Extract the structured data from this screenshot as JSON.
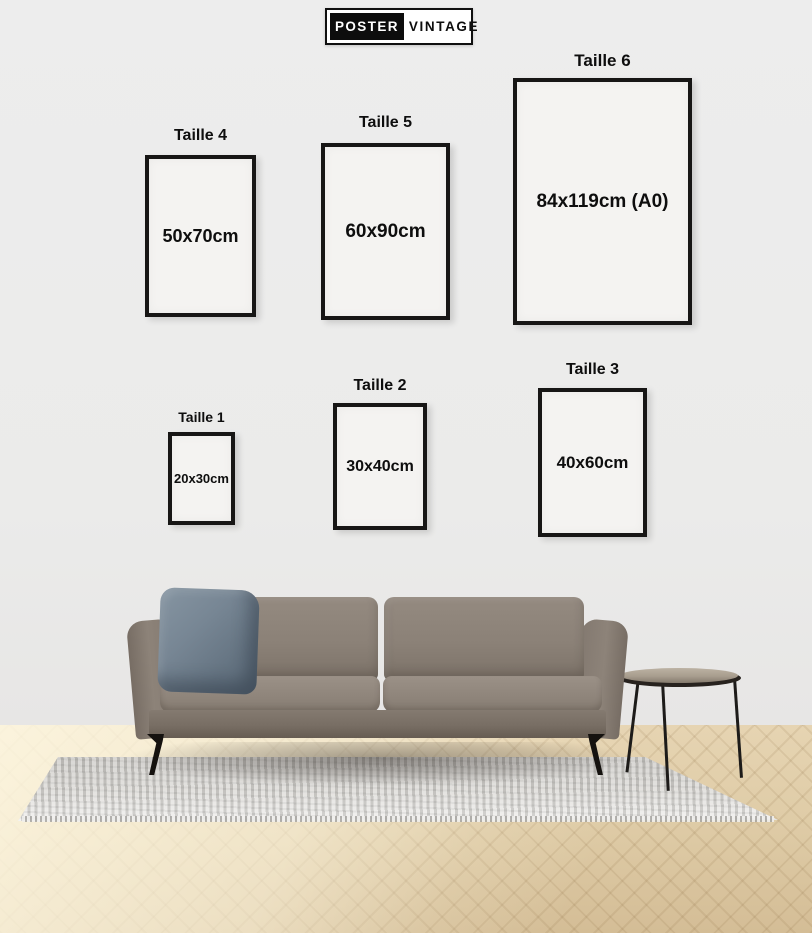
{
  "brand": {
    "name_left": "POSTER",
    "name_right": "VINTAGE"
  },
  "size_guide": {
    "frames": [
      {
        "label": "Taille 1",
        "size": "20x30cm"
      },
      {
        "label": "Taille 2",
        "size": "30x40cm"
      },
      {
        "label": "Taille 3",
        "size": "40x60cm"
      },
      {
        "label": "Taille 4",
        "size": "50x70cm"
      },
      {
        "label": "Taille 5",
        "size": "60x90cm"
      },
      {
        "label": "Taille 6",
        "size": "84x119cm (A0)"
      }
    ]
  },
  "colors": {
    "wall": "#ececec",
    "frame_border": "#171615",
    "frame_fill": "#f4f3f1",
    "text": "#0e0e0e",
    "sofa": "#8b8177",
    "pillow": "#72818f",
    "floor_wood": "#dfcca7",
    "rug": "#d8d6d2",
    "logo_black": "#0d0d0d"
  },
  "scene": {
    "description": "living room with sofa, blue throw pillow, round side table, gray rug on herringbone wood floor"
  }
}
